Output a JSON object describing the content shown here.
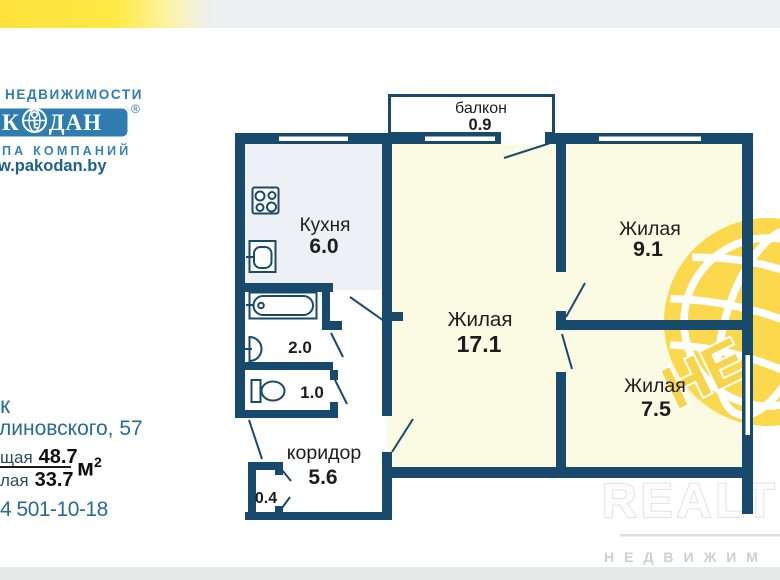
{
  "logo": {
    "agency_line": "НЕДВИЖИМОСТИ",
    "brand_left": "К",
    "brand_right": "ДАН",
    "registered": "®",
    "group_line": "ПА  КОМПАНИЙ",
    "website": "w.pakodan.by"
  },
  "listing": {
    "city_fragment": "к",
    "street_fragment": "линовского, 57",
    "total_label_fragment": "щая",
    "total_area": "48.7",
    "living_label_fragment": "лая",
    "living_area": "33.7",
    "unit": "м",
    "unit_exp": "2",
    "phone_fragment": "4 501-10-18"
  },
  "floorplan": {
    "balcony": {
      "label": "балкон",
      "area": "0.9"
    },
    "kitchen": {
      "label": "Кухня",
      "area": "6.0"
    },
    "living_main": {
      "label": "Жилая",
      "area": "17.1"
    },
    "living_2": {
      "label": "Жилая",
      "area": "9.1"
    },
    "living_3": {
      "label": "Жилая",
      "area": "7.5"
    },
    "corridor": {
      "label": "коридор",
      "area": "5.6"
    },
    "bathroom": {
      "area": "2.0"
    },
    "toilet": {
      "area": "1.0"
    },
    "closet": {
      "area": "0.4"
    }
  },
  "watermarks": {
    "realt_title": "REALT",
    "realt_subtitle": "НЕДВИЖИМ",
    "globe_letters": "НЕ"
  },
  "colors": {
    "wall": "#174a6d",
    "room_fill": "#fbfae3",
    "kitchen_fill": "#edf0f4",
    "banner_yellow": "#ffe946",
    "banner_gray": "#edeff1",
    "logo_blue": "#2e7cb0",
    "info_text_blue": "#2a6b94",
    "globe_yellow": "#fbd84c",
    "watermark_gray": "#e2e2e2"
  }
}
